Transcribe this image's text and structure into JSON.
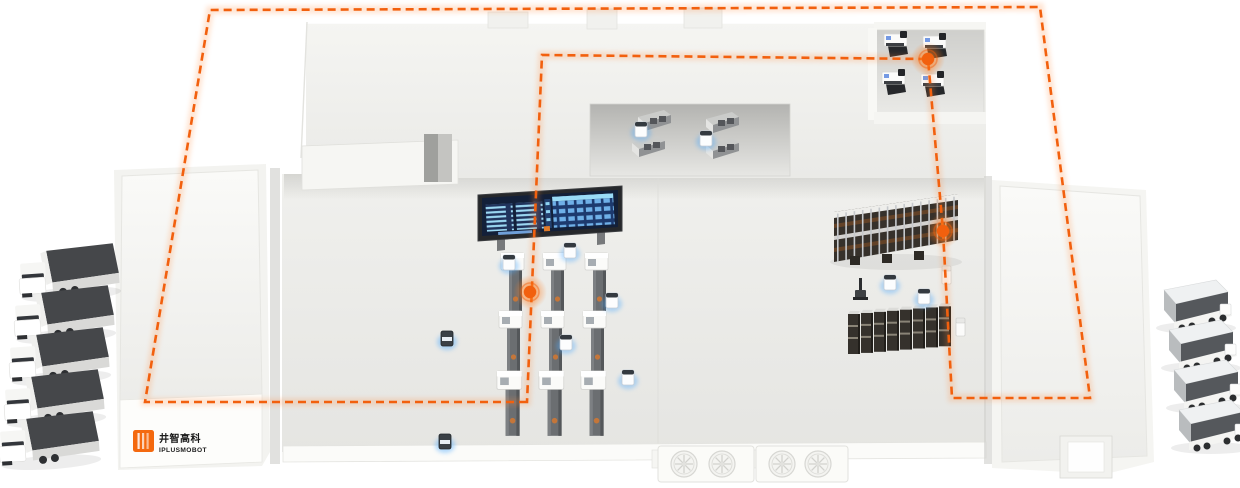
{
  "page": {
    "background": "#ffffff",
    "description": "Isometric smart-factory scene with AMR fleet, dashed route loop, docks and trucks"
  },
  "branding": {
    "logo_text_cn": "井智高科",
    "logo_text_en": "IPLUSMOBOT",
    "logo_color": "#f4690f",
    "logo_text_color": "#1b1b1b"
  },
  "route": {
    "color": "#f2600e",
    "glow_color": "#ff8a3c",
    "style": "dashed",
    "waypoints": 3
  },
  "fleet": {
    "left_dock_trucks": 5,
    "right_dock_trucks": 4,
    "white_agvs": 9,
    "dark_agvs": 2,
    "loader_bots": 2,
    "forklift_bots": 1
  },
  "equipment": {
    "machine_columns": 3,
    "machines_per_column": 3,
    "cnc_machines": 4,
    "workbenches": 4,
    "upper_rack_posts": 15,
    "lower_rack_modules": 8,
    "dock_fans": 4
  },
  "dashboard": {
    "frame_color": "#26282b",
    "screen_bg": "#132039",
    "row_color": "#8fd3f2",
    "panel_color": "#1d3a6e",
    "accent_chip": "#e07b2a"
  },
  "glow": {
    "agv_glow_color": "#4aa8ff",
    "waypoint_glow_color": "#ff7a1a"
  }
}
